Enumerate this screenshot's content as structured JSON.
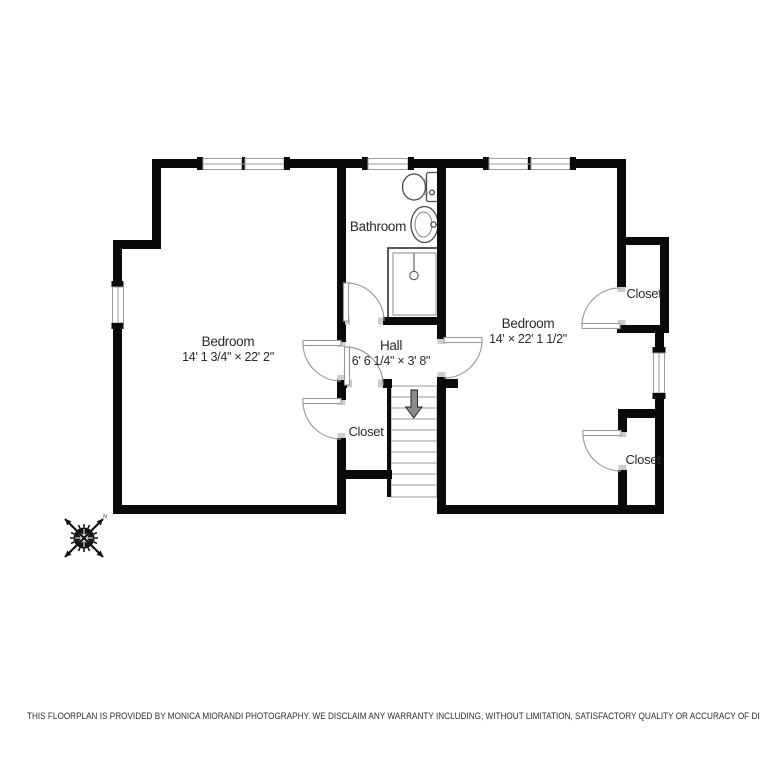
{
  "floorplan": {
    "rooms": {
      "bedroom_left": {
        "label": "Bedroom",
        "dimensions": "14' 1 3/4\" × 22' 2\""
      },
      "bathroom": {
        "label": "Bathroom"
      },
      "hall": {
        "label": "Hall",
        "dimensions": "6' 6 1/4\" × 3' 8\""
      },
      "closet_mid": {
        "label": "Closet"
      },
      "bedroom_right": {
        "label": "Bedroom",
        "dimensions": "14' × 22' 1 1/2\""
      },
      "closet_ne": {
        "label": "Closet"
      },
      "closet_se": {
        "label": "Closet"
      }
    },
    "compass": {
      "north_letter": "N"
    },
    "colors": {
      "wall": "#0a0a0a",
      "door_swing": "#9a9a9a",
      "stair_arrow": "#8c8c8c",
      "label_text": "#2b2b2b",
      "background": "#ffffff"
    }
  },
  "footer": {
    "disclaimer": "THIS FLOORPLAN IS PROVIDED BY MONICA MIORANDI PHOTOGRAPHY. WE DISCLAIM ANY WARRANTY INCLUDING, WITHOUT LIMITATION, SATISFACTORY QUALITY OR ACCURACY OF DIMENSIONS."
  }
}
